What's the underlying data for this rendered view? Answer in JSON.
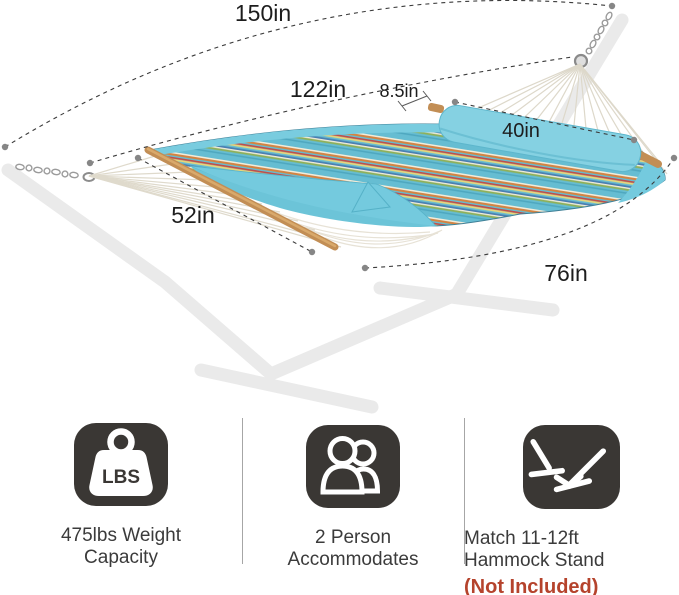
{
  "diagram": {
    "labels": {
      "d150": "150in",
      "d122": "122in",
      "d85": "8.5in",
      "d40": "40in",
      "d52": "52in",
      "d76": "76in"
    }
  },
  "features": {
    "weight": {
      "icon": "weight-lbs-icon",
      "icon_text": "LBS",
      "line1": "475lbs Weight",
      "line2": "Capacity"
    },
    "persons": {
      "icon": "two-person-icon",
      "line1": "2 Person",
      "line2": "Accommodates"
    },
    "stand": {
      "icon": "hammock-stand-icon",
      "line1": "Match 11-12ft",
      "line2": "Hammock Stand",
      "note": "(Not Included)"
    }
  },
  "colors": {
    "note_red": "#b5432c",
    "icon_bg": "#3a3734",
    "pillow": "#85d1e2",
    "fabric_teal": "#66bdd2",
    "fold_blue": "#74cade",
    "wood": "#c28e55",
    "rope": "#e0dbcd",
    "stand_ghost": "#eaeaea",
    "dash_line": "#3b3b3b",
    "dot": "#868686"
  }
}
